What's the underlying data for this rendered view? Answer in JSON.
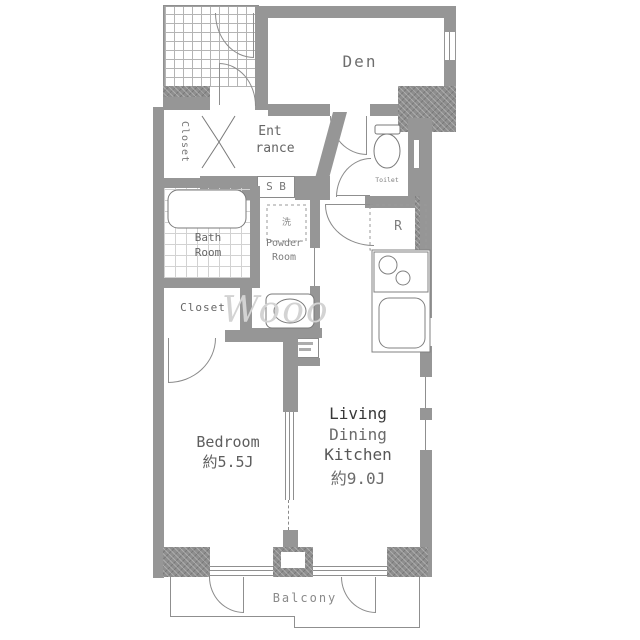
{
  "labels": {
    "den": "Den",
    "entrance_1": "Ent",
    "entrance_2": "rance",
    "shoe_box": "S B",
    "closet_upper": "Closet",
    "toilet": "Toilet",
    "bath_1": "Bath",
    "bath_2": "Room",
    "powder_1": "Powder",
    "powder_2": "Room",
    "washer": "洗",
    "refrigerator": "R",
    "closet_lower": "Closet",
    "bedroom_1": "Bedroom",
    "bedroom_2": "約5.5J",
    "ldk_1": "Living",
    "ldk_2": "Dining",
    "ldk_3": "Kitchen",
    "ldk_4": "約9.0J",
    "balcony": "Balcony",
    "watermark": "Wooo"
  },
  "room_sizes": {
    "bedroom": "約5.5J",
    "living_dining_kitchen": "約9.0J"
  },
  "colors": {
    "wall": "#969696",
    "structure_hatch": "#8e8e8e",
    "line": "#8f8f8f",
    "label_text": "#666666",
    "watermark": "#d3d3d3",
    "background": "#ffffff"
  }
}
